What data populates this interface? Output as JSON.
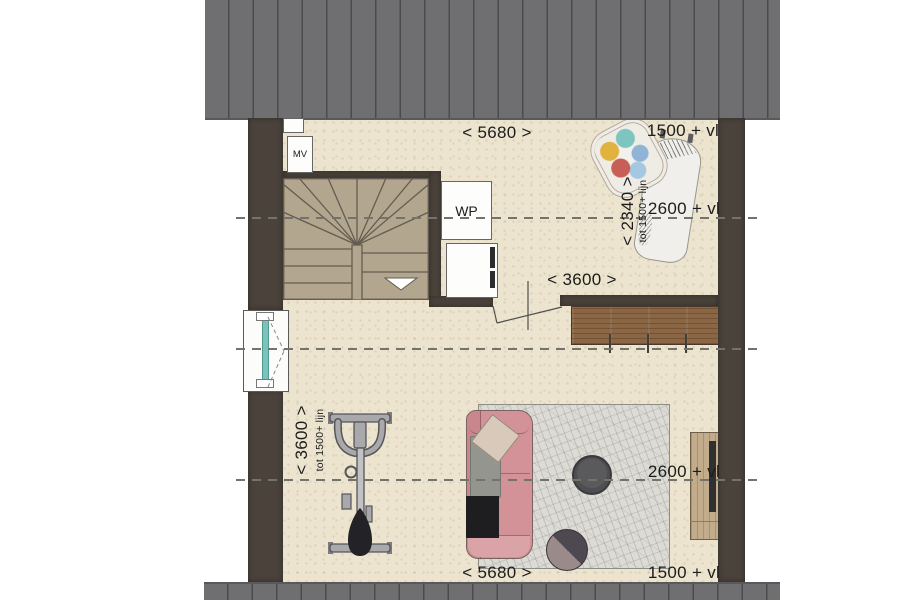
{
  "drawing": {
    "type": "attic floor plan"
  },
  "labels": {
    "mv": "MV",
    "wp": "WP"
  },
  "dimensions": {
    "top_width": "< 5680 >",
    "bottom_width": "< 5680 >",
    "middle_width": "< 3600 >",
    "left_height": "< 3600 >",
    "left_height_note": "tot 1500+ lijn",
    "right_height": "< 2340 >",
    "right_height_note": "tot 1500+ lijn"
  },
  "level_marks": {
    "top_right": "1500 + vl",
    "upper_right": "2600 + vl",
    "lower_right": "2600 + vl",
    "bottom_right": "1500 + vl"
  },
  "objects": [
    "staircase",
    "mechanical-ventilation-unit",
    "heat-pump",
    "washing-machine",
    "interior-door",
    "window",
    "sideboard",
    "ironing-board",
    "laundry-basket",
    "exercise-bike",
    "sofa",
    "rug",
    "side-table",
    "pouf",
    "tv-cabinet"
  ],
  "colors": {
    "roof": "#6f6e70",
    "roofseam": "#4b4a4c",
    "wall": "#4a423b",
    "floor": "#ece4ce",
    "stair": "#b3a68e",
    "stairline": "#645c50",
    "wood": "#8a6645",
    "woodlight": "#c2ac8c",
    "rug": "#dcdbd5",
    "sofa": "#d29298",
    "pillow": "#d8c9ba",
    "throw": "#95958f",
    "dark": "#1e1e20",
    "table": "#4e4d4f",
    "poufdark": "#4e4851",
    "pouflight": "#9a8a8a",
    "bike": "#a9a9ab",
    "bikedark": "#55555a",
    "teal": "#7cc2b9",
    "dash": "#73736c",
    "ink": "#1c1c1c",
    "boxline": "#666666"
  }
}
